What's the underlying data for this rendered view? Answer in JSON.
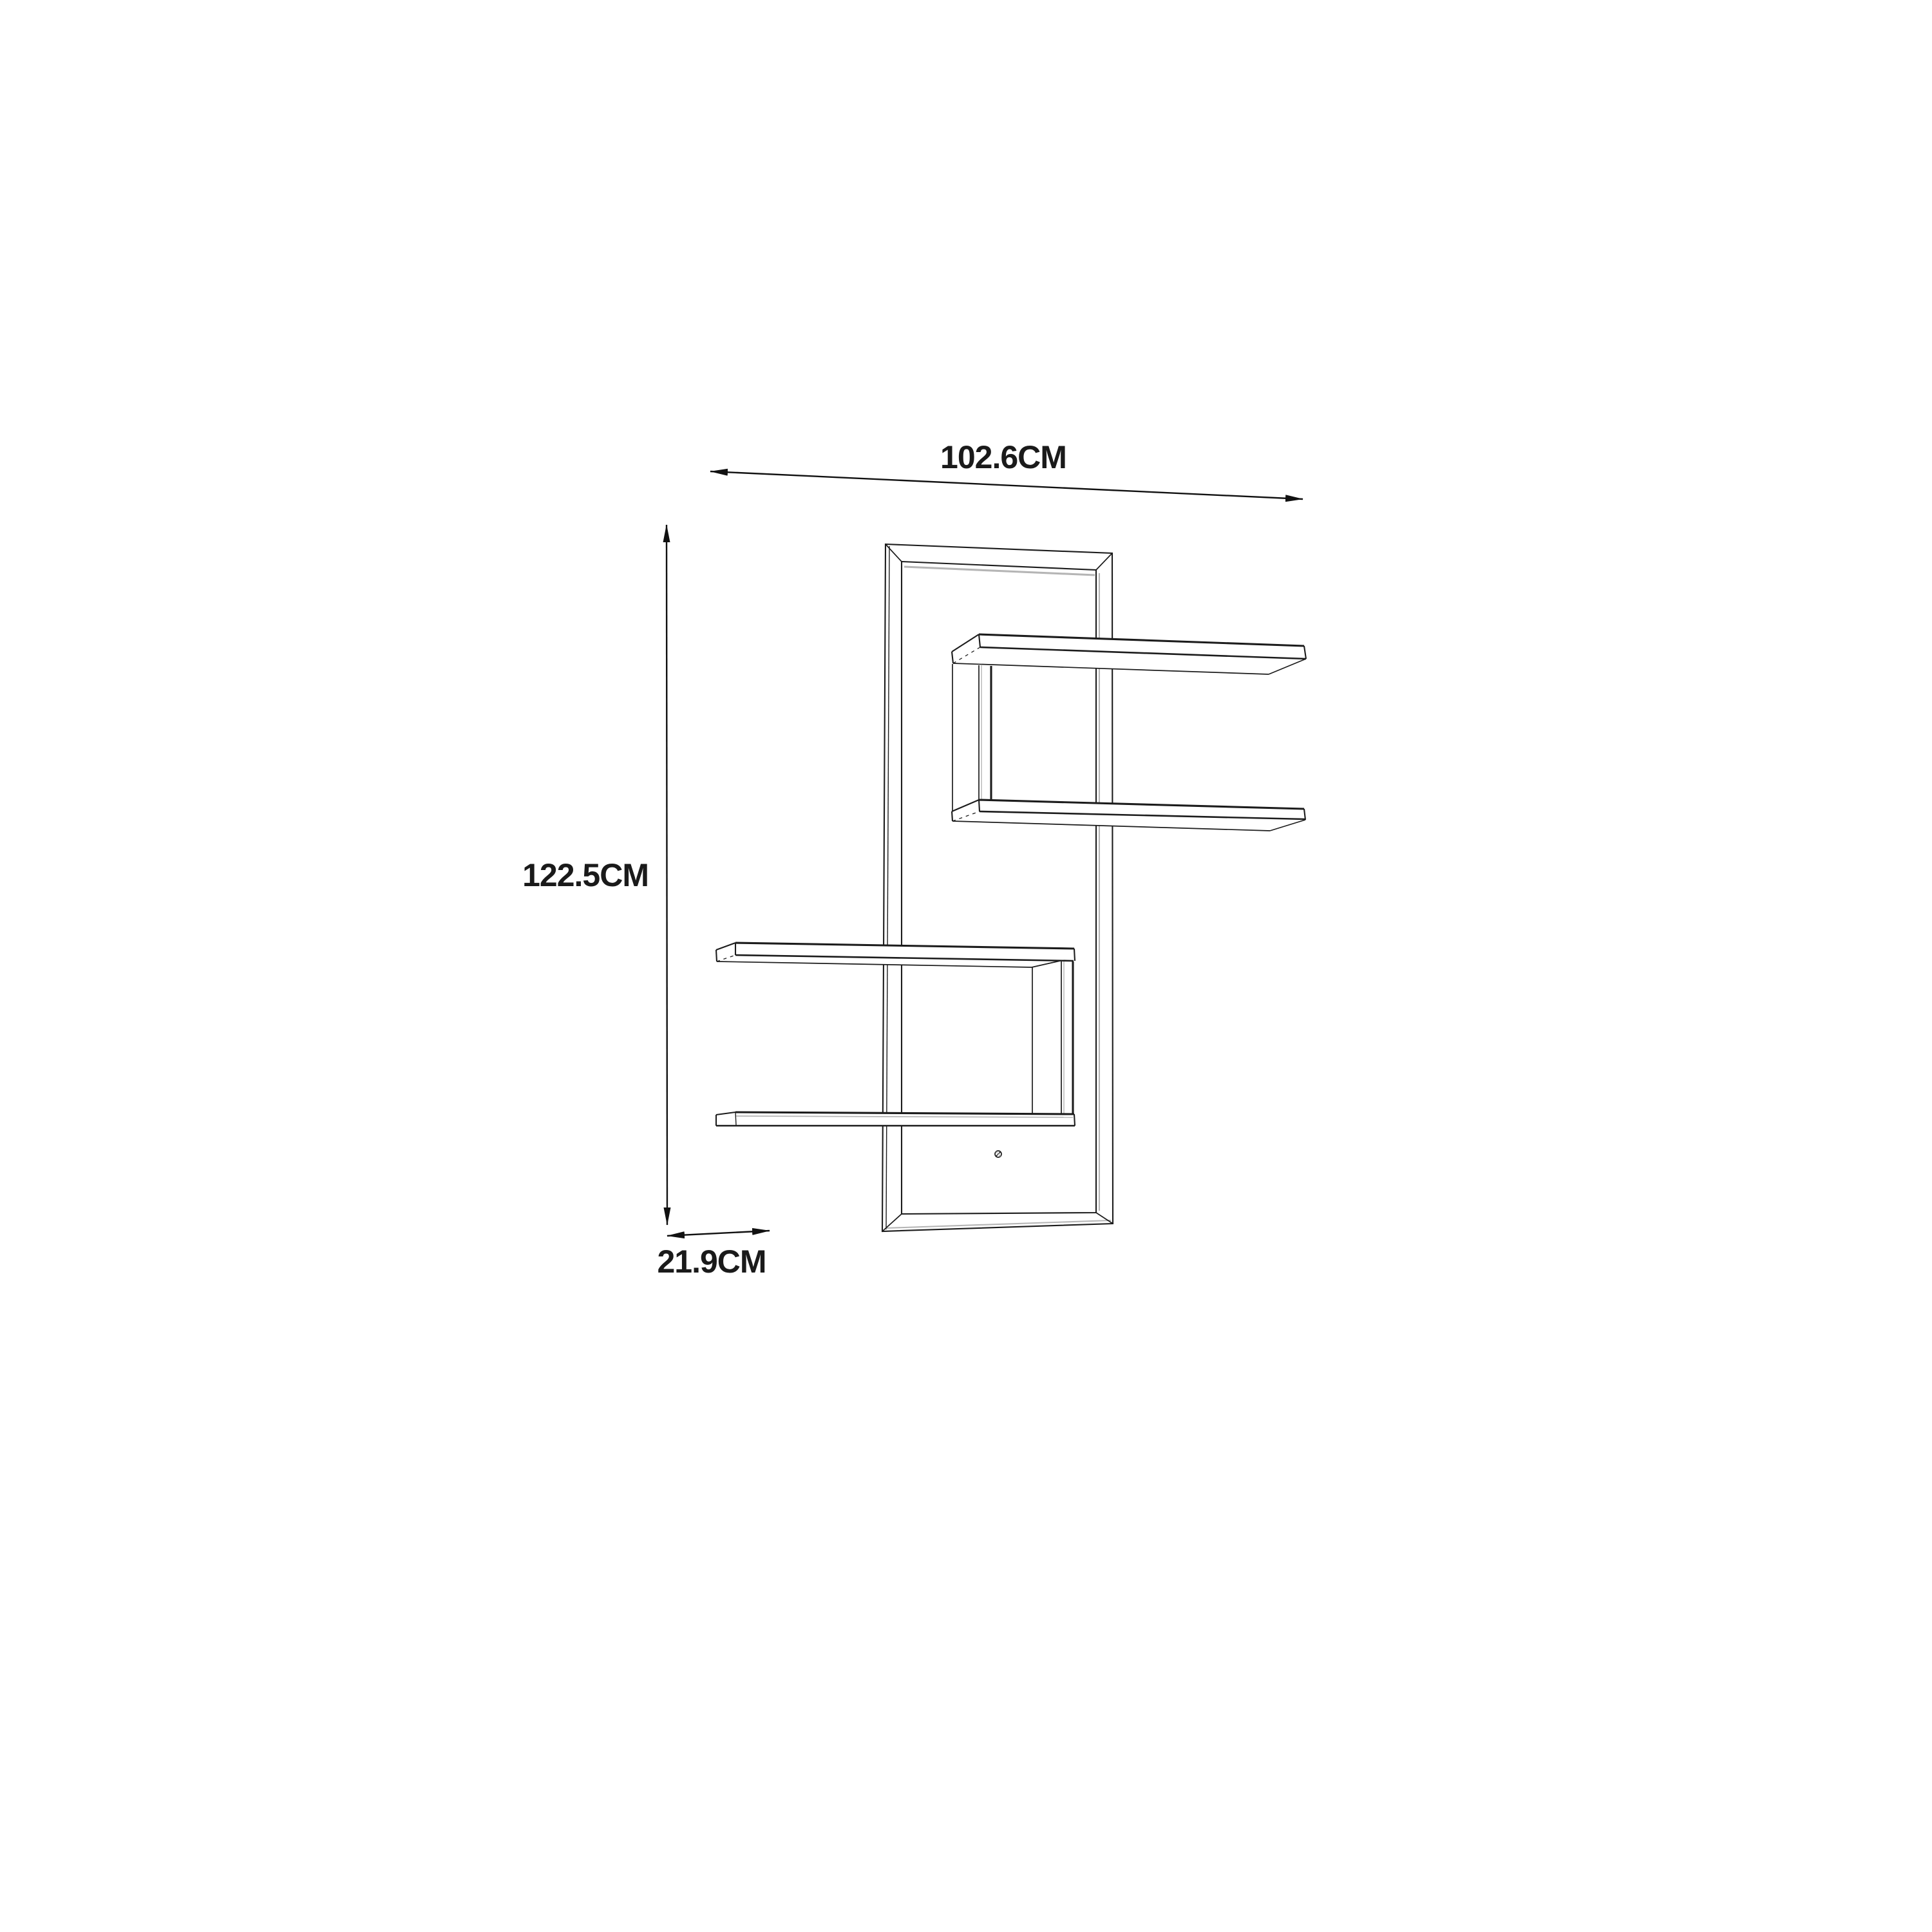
{
  "page": {
    "background_color": "#ffffff"
  },
  "diagram": {
    "kind": "furniture dimension line drawing",
    "labels": {
      "width": "102.6CM",
      "height": "122.5CM",
      "depth": "21.9CM"
    },
    "style": {
      "line_color": "#1c1c1c",
      "light_line_color": "#b5b5b5",
      "text_color": "#1a1a1a",
      "background": "#ffffff"
    }
  }
}
